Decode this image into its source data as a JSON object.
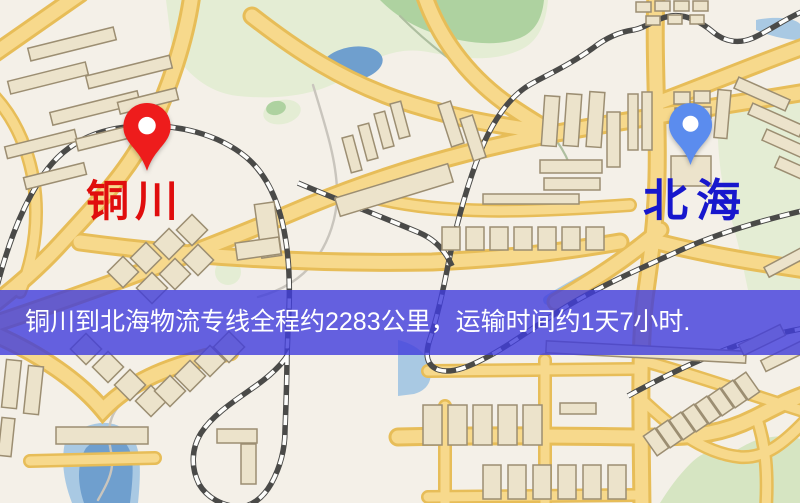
{
  "map": {
    "origin": {
      "name": "铜川",
      "marker": "red-map-pin"
    },
    "destination": {
      "name": "北海",
      "marker": "blue-map-pin"
    },
    "banner": {
      "text": "铜川到北海物流专线全程约2283公里，运输时间约1天7小时."
    },
    "route_info": {
      "distance_km": "2283",
      "duration": "1天7小时"
    },
    "colors": {
      "land": "#f4f0e8",
      "park": "#e4edd4",
      "park_mid": "#d6e5c2",
      "park_dark": "#aed2a0",
      "water": "#6f9fce",
      "water_light": "#a9c9e3",
      "stream": "#c9c5bd",
      "stream_green": "#aebfa0",
      "road_fill": "#f7d98c",
      "road_casing": "#e7bd58",
      "rail_dark": "#4a4a48",
      "rail_light": "#fdfdfb",
      "building_fill": "#ece3cb",
      "building_stroke": "#9c8e72",
      "banner_bg": "rgba(64,60,220,0.8)",
      "banner_text": "#ffffff",
      "origin_pin": "#ee1c1c",
      "origin_label": "#e00d0d",
      "dest_pin": "#5b8cee",
      "dest_label": "#1717cd"
    }
  }
}
